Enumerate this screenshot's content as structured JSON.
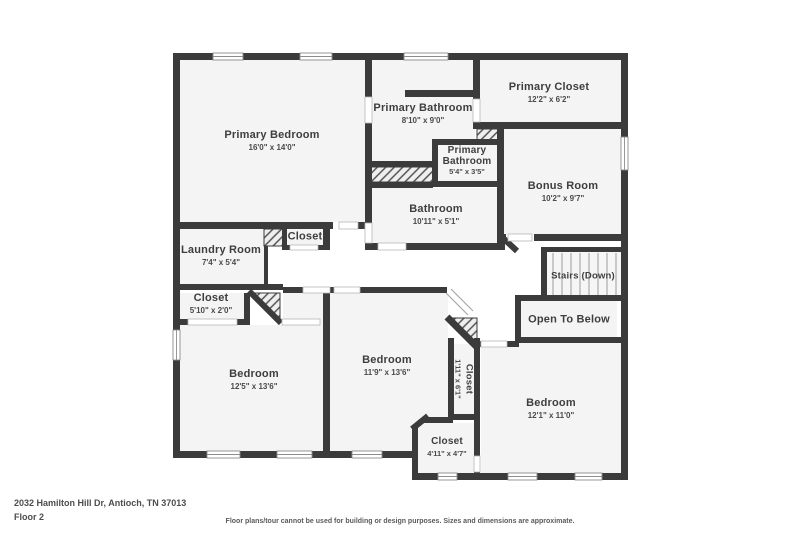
{
  "meta": {
    "address": "2032 Hamilton Hill Dr, Antioch, TN 37013",
    "floor_label": "Floor 2",
    "disclaimer": "Floor plans/tour cannot be used for building or design purposes. Sizes and dimensions are approximate."
  },
  "colors": {
    "wall": "#3b3b3b",
    "room_fill": "#f4f4f4",
    "text": "#3e3e3e"
  },
  "rooms": [
    {
      "id": "primary-bedroom",
      "name": "Primary Bedroom",
      "dims": "16'0\" x 14'0\""
    },
    {
      "id": "primary-bathroom",
      "name": "Primary Bathroom",
      "dims": "8'10\" x 9'0\""
    },
    {
      "id": "primary-closet",
      "name": "Primary Closet",
      "dims": "12'2\" x 6'2\""
    },
    {
      "id": "primary-bathroom-small",
      "name": "Primary Bathroom",
      "dims": "5'4\" x 3'5\""
    },
    {
      "id": "bathroom",
      "name": "Bathroom",
      "dims": "10'11\" x 5'1\""
    },
    {
      "id": "bonus-room",
      "name": "Bonus Room",
      "dims": "10'2\" x 9'7\""
    },
    {
      "id": "laundry-room",
      "name": "Laundry Room",
      "dims": "7'4\" x 5'4\""
    },
    {
      "id": "hall-closet",
      "name": "Closet",
      "dims": ""
    },
    {
      "id": "stairs",
      "name": "Stairs (Down)",
      "dims": ""
    },
    {
      "id": "open-to-below",
      "name": "Open To Below",
      "dims": ""
    },
    {
      "id": "closet-left",
      "name": "Closet",
      "dims": "5'10\" x 2'0\""
    },
    {
      "id": "bedroom-left",
      "name": "Bedroom",
      "dims": "12'5\" x 13'6\""
    },
    {
      "id": "bedroom-middle",
      "name": "Bedroom",
      "dims": "11'9\" x 13'6\""
    },
    {
      "id": "closet-vertical",
      "name": "Closet",
      "dims": "1'11\" x 6'1\""
    },
    {
      "id": "bedroom-right",
      "name": "Bedroom",
      "dims": "12'1\" x 11'0\""
    },
    {
      "id": "closet-bottom",
      "name": "Closet",
      "dims": "4'11\" x 4'7\""
    }
  ]
}
